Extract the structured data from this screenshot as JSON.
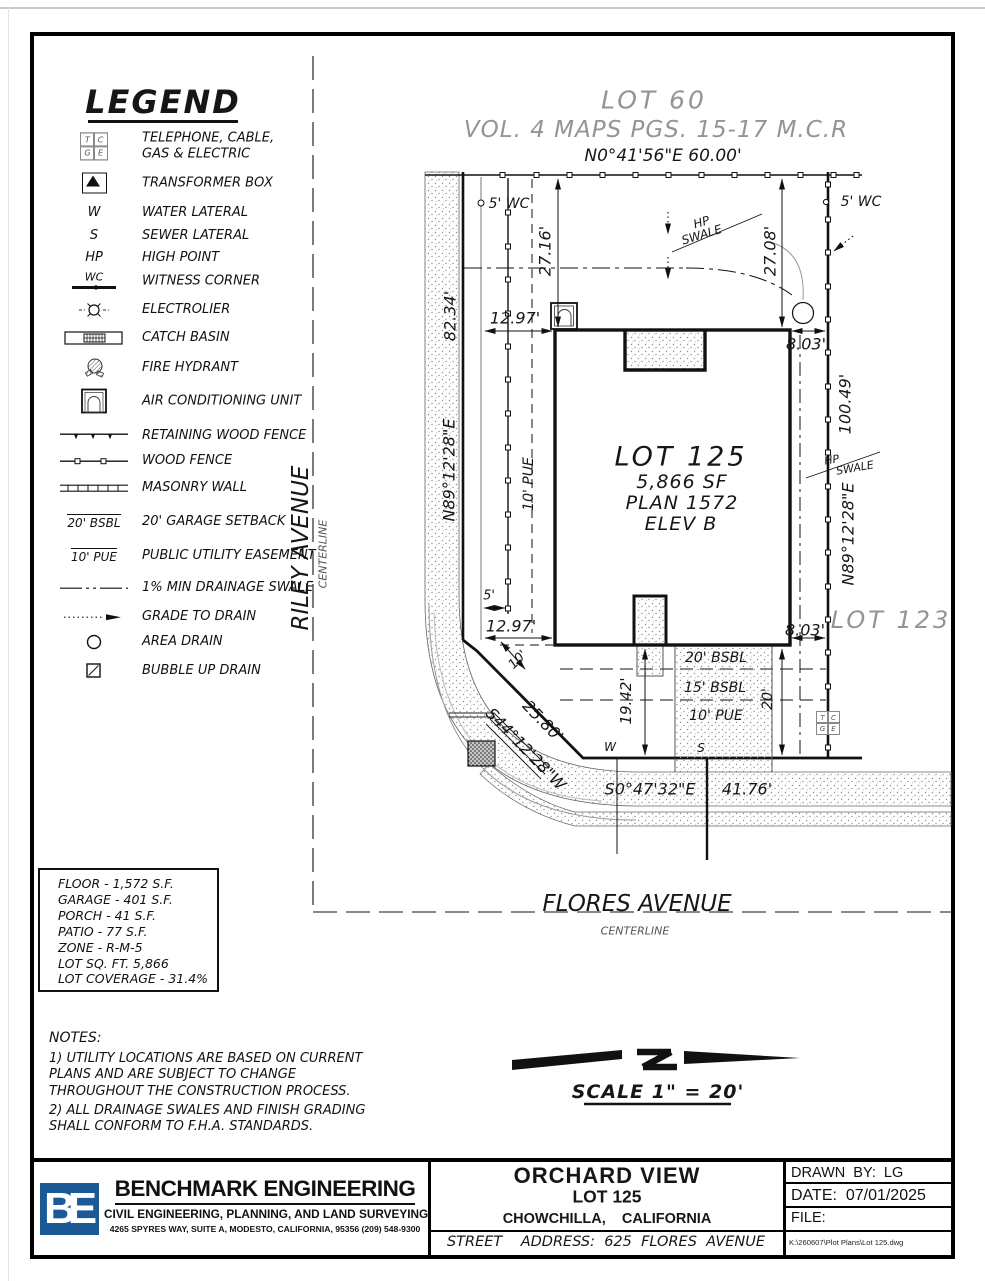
{
  "page": {
    "bg": "#ffffff",
    "ink": "#111111",
    "muted": "#949494",
    "logo_blue": "#1b5a97"
  },
  "legend": {
    "title": "LEGEND",
    "tcge": {
      "t": "T",
      "c": "C",
      "g": "G",
      "e": "E"
    },
    "items": [
      {
        "label": "TELEPHONE, CABLE, GAS & ELECTRIC"
      },
      {
        "label": "TRANSFORMER BOX"
      },
      {
        "symbol_text": "W",
        "label": "WATER LATERAL"
      },
      {
        "symbol_text": "S",
        "label": "SEWER LATERAL"
      },
      {
        "symbol_text": "HP",
        "label": "HIGH POINT"
      },
      {
        "symbol_text": "WC",
        "label": "WITNESS CORNER"
      },
      {
        "label": "ELECTROLIER"
      },
      {
        "label": "CATCH BASIN"
      },
      {
        "label": "FIRE HYDRANT"
      },
      {
        "label": "AIR CONDITIONING UNIT"
      },
      {
        "label": "RETAINING WOOD FENCE"
      },
      {
        "label": "WOOD FENCE"
      },
      {
        "label": "MASONRY WALL"
      },
      {
        "symbol_text": "20' BSBL",
        "label": "20' GARAGE SETBACK"
      },
      {
        "symbol_text": "10' PUE",
        "label": "PUBLIC UTILITY EASEMENT"
      },
      {
        "label": "1% MIN DRAINAGE SWALE"
      },
      {
        "label": "GRADE TO DRAIN"
      },
      {
        "label": "AREA DRAIN"
      },
      {
        "label": "BUBBLE UP DRAIN"
      }
    ]
  },
  "streets": {
    "riley": "RILEY AVENUE",
    "riley_sub": "CENTERLINE",
    "flores": "FLORES AVENUE",
    "flores_sub": "CENTERLINE"
  },
  "plan": {
    "lot60": "LOT 60",
    "map_ref": "VOL. 4 MAPS PGS. 15-17 M.C.R",
    "north_bearing": "N0°41'56\"E   60.00'",
    "wc_left": "5' WC",
    "wc_right": "5' WC",
    "dim_27_16": "27.16'",
    "dim_27_08": "27.08'",
    "hp": "HP",
    "swale": "SWALE",
    "west_dist": "82.34'",
    "west_bearing": "N89°12'28\"E",
    "east_dist": "100.49'",
    "east_bearing": "N89°12'28\"E",
    "dim_12_97_top": "12.97'",
    "dim_12_97_bottom": "12.97'",
    "dim_8_03_top": "8.03'",
    "dim_8_03_bottom": "8.03'",
    "pue_west": "10' PUE",
    "lot_name": "LOT 125",
    "lot_sf": "5,866 SF",
    "plan_no": "PLAN 1572",
    "elev": "ELEV B",
    "lot123": "LOT 123",
    "dim_5": "5'",
    "dim_10": "10'",
    "dim_25_80": "25.80'",
    "sw_bearing": "S44°12'28\"W",
    "dim_19_42": "19.42'",
    "dim_20": "20'",
    "bsbl_20": "20' BSBL",
    "bsbl_15": "15' BSBL",
    "pue_10": "10' PUE",
    "water": "W",
    "sewer": "S",
    "south_bearing": "S0°47'32\"E",
    "south_dist": "41.76'"
  },
  "stats": {
    "lines": [
      "FLOOR - 1,572 S.F.",
      "GARAGE - 401 S.F.",
      "PORCH - 41 S.F.",
      "PATIO - 77 S.F.",
      "ZONE - R-M-5",
      "LOT SQ. FT. 5,866",
      "LOT COVERAGE - 31.4%"
    ]
  },
  "notes": {
    "title": "NOTES:",
    "note1": "1) UTILITY LOCATIONS ARE BASED ON CURRENT PLANS AND ARE SUBJECT TO CHANGE THROUGHOUT THE CONSTRUCTION PROCESS.",
    "note2": "2) ALL DRAINAGE SWALES AND FINISH GRADING SHALL CONFORM TO F.H.A. STANDARDS."
  },
  "scale": {
    "label": "SCALE  1\" = 20'"
  },
  "titleblock": {
    "logo_text": "BE",
    "company": "BENCHMARK ENGINEERING",
    "tagline": "CIVIL ENGINEERING, PLANNING, AND LAND SURVEYING",
    "address": "4265 SPYRES WAY, SUITE A, MODESTO, CALIFORNIA, 95356    (209) 548-9300",
    "project": "ORCHARD VIEW",
    "lot": "LOT 125",
    "city": "CHOWCHILLA,    CALIFORNIA",
    "street_address": "STREET    ADDRESS:  625  FLORES  AVENUE",
    "drawn_by": "DRAWN  BY:  LG",
    "date": "DATE:  07/01/2025",
    "file_label": "FILE:",
    "file_path": "K:\\260607\\Plot Plans\\Lot 125.dwg"
  }
}
